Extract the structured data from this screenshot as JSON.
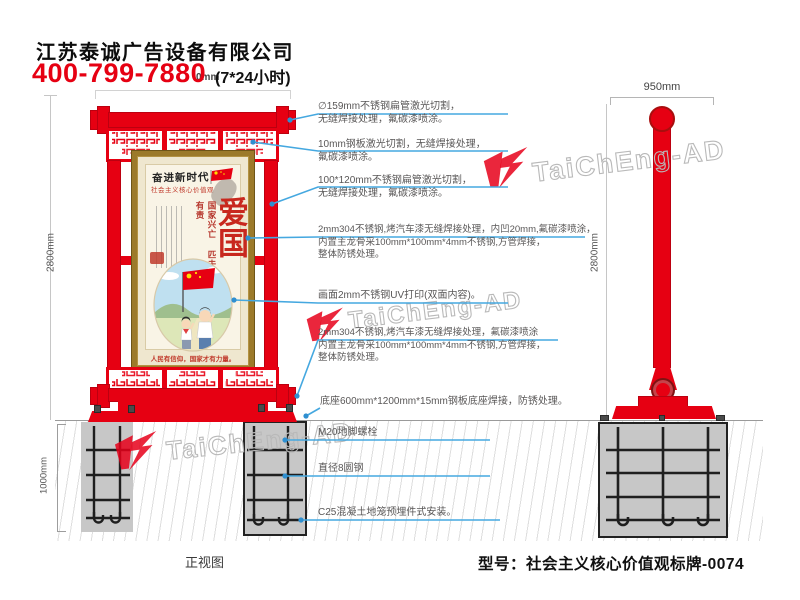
{
  "header": {
    "company": "江苏泰诚广告设备有限公司",
    "phone": "400-799-7880",
    "hours": "(7*24小时)",
    "dim_fragment": "0mm"
  },
  "views": {
    "front_label": "正视图",
    "front_height": "2800mm",
    "front_underground": "1000mm",
    "side_width": "950mm",
    "side_height": "2800mm"
  },
  "poster": {
    "calligraphy": "奋进新时代",
    "series": "社会主义核心价值观",
    "main_title": "爱国",
    "vertical_slogan": "国家兴亡 匹夫有责",
    "caption": "人民有信仰，国家才有力量。"
  },
  "annotations": {
    "a1": {
      "l1": "∅159mm不锈钢扁管激光切割，",
      "l2": "无缝焊接处理，氟碳漆喷涂。"
    },
    "a2": {
      "l1": "10mm钢板激光切割，无缝焊接处理，",
      "l2": "氟碳漆喷涂。"
    },
    "a3": {
      "l1": "100*120mm不锈钢扁管激光切割，",
      "l2": "无缝焊接处理，氟碳漆喷涂。"
    },
    "a4": {
      "l1": "2mm304不锈钢,烤汽车漆无缝焊接处理，内凹20mm,氟碳漆喷涂，",
      "l2": "内置主龙骨采100mm*100mm*4mm不锈钢,方管焊接，",
      "l3": "整体防锈处理。"
    },
    "a5": {
      "l1": "画面2mm不锈钢UV打印(双面内容)。"
    },
    "a6": {
      "l1": "2mm304不锈钢,烤汽车漆无缝焊接处理，氟碳漆喷涂",
      "l2": "内置主龙骨采100mm*100mm*4mm不锈钢,方管焊接，",
      "l3": "整体防锈处理。"
    },
    "a7": {
      "l1": "底座600mm*1200mm*15mm钢板底座焊接，防锈处理。"
    },
    "a8": {
      "l1": "M20地脚螺栓"
    },
    "a9": {
      "l1": "直径8圆钢"
    },
    "a10": {
      "l1": "C25混凝土地笼预埋件式安装。"
    }
  },
  "watermark": {
    "text": "TaiChEng-AD"
  },
  "footer": {
    "model": "型号：社会主义核心价值观标牌-0074"
  },
  "colors": {
    "brand_red": "#e60012",
    "leader_blue": "#45a8e0",
    "annotation_gray": "#595757",
    "concrete": "#c7c7c7",
    "gold_frame": "#9c7a2a"
  }
}
